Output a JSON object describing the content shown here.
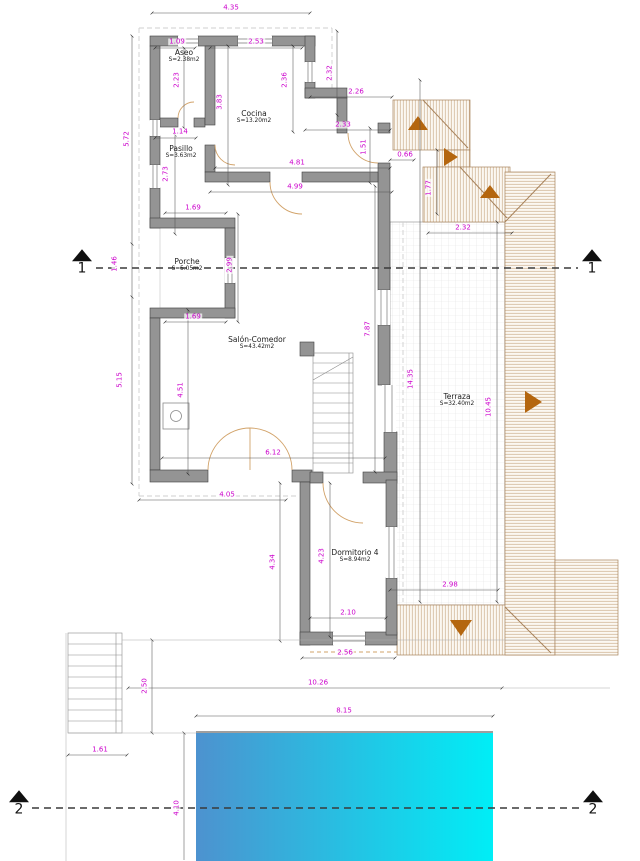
{
  "colors": {
    "dimension_text": "#cc00cc",
    "wall_fill": "#949494",
    "wall_edge": "#3f3f3f",
    "roof_line": "#a8835c",
    "roof_hatch": "#bb9468",
    "roof_arrow": "#b4660f",
    "pool_left": "#4d92cf",
    "pool_right": "#00eef6",
    "grid_line": "#e2e2e2",
    "door_arc": "#d2a36a",
    "section_line": "#3a3a3a",
    "dim_line": "#555555"
  },
  "rooms": [
    {
      "name": "Aseo",
      "area": "S=2.38m2",
      "x": 184,
      "y": 56
    },
    {
      "name": "Cocina",
      "area": "S=13.20m2",
      "x": 254,
      "y": 117
    },
    {
      "name": "Pasillo",
      "area": "S=3.63m2",
      "x": 181,
      "y": 152
    },
    {
      "name": "Porche",
      "area": "S=5.05m2",
      "x": 187,
      "y": 265
    },
    {
      "name": "Salón-Comedor",
      "area": "S=43.42m2",
      "x": 257,
      "y": 343
    },
    {
      "name": "Terraza",
      "area": "S=32.40m2",
      "x": 457,
      "y": 400
    },
    {
      "name": "Dormitorio 4",
      "area": "S=8.94m2",
      "x": 355,
      "y": 556
    }
  ],
  "section_markers": [
    {
      "label": "1",
      "x": 82,
      "y": 263
    },
    {
      "label": "1",
      "x": 592,
      "y": 263
    },
    {
      "label": "2",
      "x": 19,
      "y": 804
    },
    {
      "label": "2",
      "x": 593,
      "y": 804
    }
  ],
  "dimensions": [
    {
      "text": "4.35",
      "x": 231,
      "y": 8,
      "vertical": false
    },
    {
      "text": "1.09",
      "x": 177,
      "y": 42,
      "vertical": false
    },
    {
      "text": "2.53",
      "x": 256,
      "y": 42,
      "vertical": false
    },
    {
      "text": "2.26",
      "x": 356,
      "y": 92,
      "vertical": false
    },
    {
      "text": "2.33",
      "x": 343,
      "y": 125,
      "vertical": false
    },
    {
      "text": "0.66",
      "x": 405,
      "y": 155,
      "vertical": false
    },
    {
      "text": "1.14",
      "x": 180,
      "y": 132,
      "vertical": false
    },
    {
      "text": "4.81",
      "x": 297,
      "y": 163,
      "vertical": false
    },
    {
      "text": "4.99",
      "x": 295,
      "y": 187,
      "vertical": false
    },
    {
      "text": "1.69",
      "x": 193,
      "y": 208,
      "vertical": false
    },
    {
      "text": "2.32",
      "x": 463,
      "y": 228,
      "vertical": false
    },
    {
      "text": "1.69",
      "x": 193,
      "y": 317,
      "vertical": false
    },
    {
      "text": "6.12",
      "x": 273,
      "y": 453,
      "vertical": false
    },
    {
      "text": "4.05",
      "x": 227,
      "y": 495,
      "vertical": false
    },
    {
      "text": "2.98",
      "x": 450,
      "y": 585,
      "vertical": false
    },
    {
      "text": "2.10",
      "x": 348,
      "y": 613,
      "vertical": false
    },
    {
      "text": "2.56",
      "x": 345,
      "y": 653,
      "vertical": false
    },
    {
      "text": "10.26",
      "x": 318,
      "y": 683,
      "vertical": false
    },
    {
      "text": "8.15",
      "x": 344,
      "y": 711,
      "vertical": false
    },
    {
      "text": "1.61",
      "x": 100,
      "y": 750,
      "vertical": false
    },
    {
      "text": "2.32",
      "x": 330,
      "y": 73,
      "vertical": true
    },
    {
      "text": "2.36",
      "x": 285,
      "y": 80,
      "vertical": true
    },
    {
      "text": "2.23",
      "x": 177,
      "y": 80,
      "vertical": true
    },
    {
      "text": "3.83",
      "x": 220,
      "y": 102,
      "vertical": true
    },
    {
      "text": "5.72",
      "x": 127,
      "y": 139,
      "vertical": true
    },
    {
      "text": "1.51",
      "x": 364,
      "y": 147,
      "vertical": true
    },
    {
      "text": "2.73",
      "x": 166,
      "y": 174,
      "vertical": true
    },
    {
      "text": "1.77",
      "x": 429,
      "y": 188,
      "vertical": true
    },
    {
      "text": "1.46",
      "x": 115,
      "y": 264,
      "vertical": true
    },
    {
      "text": "2.99",
      "x": 230,
      "y": 265,
      "vertical": true
    },
    {
      "text": "7.87",
      "x": 368,
      "y": 329,
      "vertical": true
    },
    {
      "text": "14.35",
      "x": 411,
      "y": 379,
      "vertical": true
    },
    {
      "text": "4.51",
      "x": 181,
      "y": 390,
      "vertical": true
    },
    {
      "text": "5.15",
      "x": 120,
      "y": 380,
      "vertical": true
    },
    {
      "text": "10.45",
      "x": 489,
      "y": 407,
      "vertical": true
    },
    {
      "text": "4.34",
      "x": 273,
      "y": 562,
      "vertical": true
    },
    {
      "text": "4.23",
      "x": 322,
      "y": 556,
      "vertical": true
    },
    {
      "text": "2.50",
      "x": 145,
      "y": 686,
      "vertical": true
    },
    {
      "text": "4.10",
      "x": 177,
      "y": 808,
      "vertical": true
    }
  ]
}
